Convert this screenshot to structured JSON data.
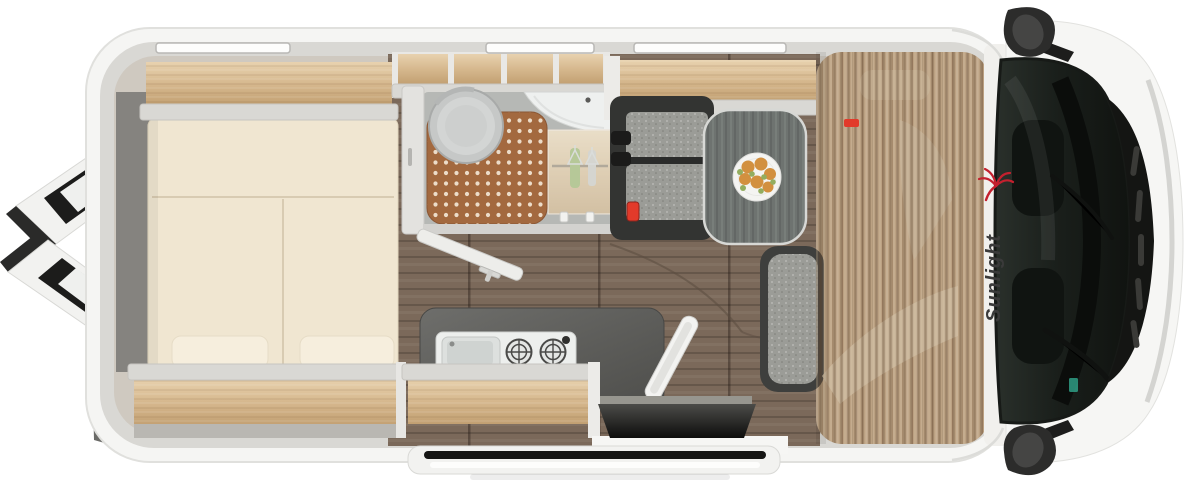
{
  "logo": {
    "text": "Sunlight",
    "palm_color": "#c4202e",
    "text_color": "#3a3a3a"
  },
  "palette": {
    "body_white": "#f5f5f3",
    "wall_gray": "#d9d8d4",
    "interior_base": "#cfc9c0",
    "mattress_cream": "#f0e6d1",
    "pillow_cream": "#f6eedd",
    "shelf_wood": "#d6b88e",
    "floor_wood": "#7b695a",
    "cab_floor_wood": "#cab293",
    "shower_terracotta": "#a3693f",
    "shower_dot": "#ecdcc9",
    "bathroom_floor": "#b6b8b5",
    "toilet_gray": "#c6c8c7",
    "counter_slate": "#5d5d5a",
    "table_gray": "#6e7370",
    "bench_frame": "#333432",
    "bench_cushion": "#9b9c97",
    "accent_red": "#e23a2a",
    "fruit_orange": "#d2903f",
    "fruit_green": "#93ad5f",
    "glass_dark": "#1a1f1b",
    "seal_black": "#1c1c1b"
  }
}
